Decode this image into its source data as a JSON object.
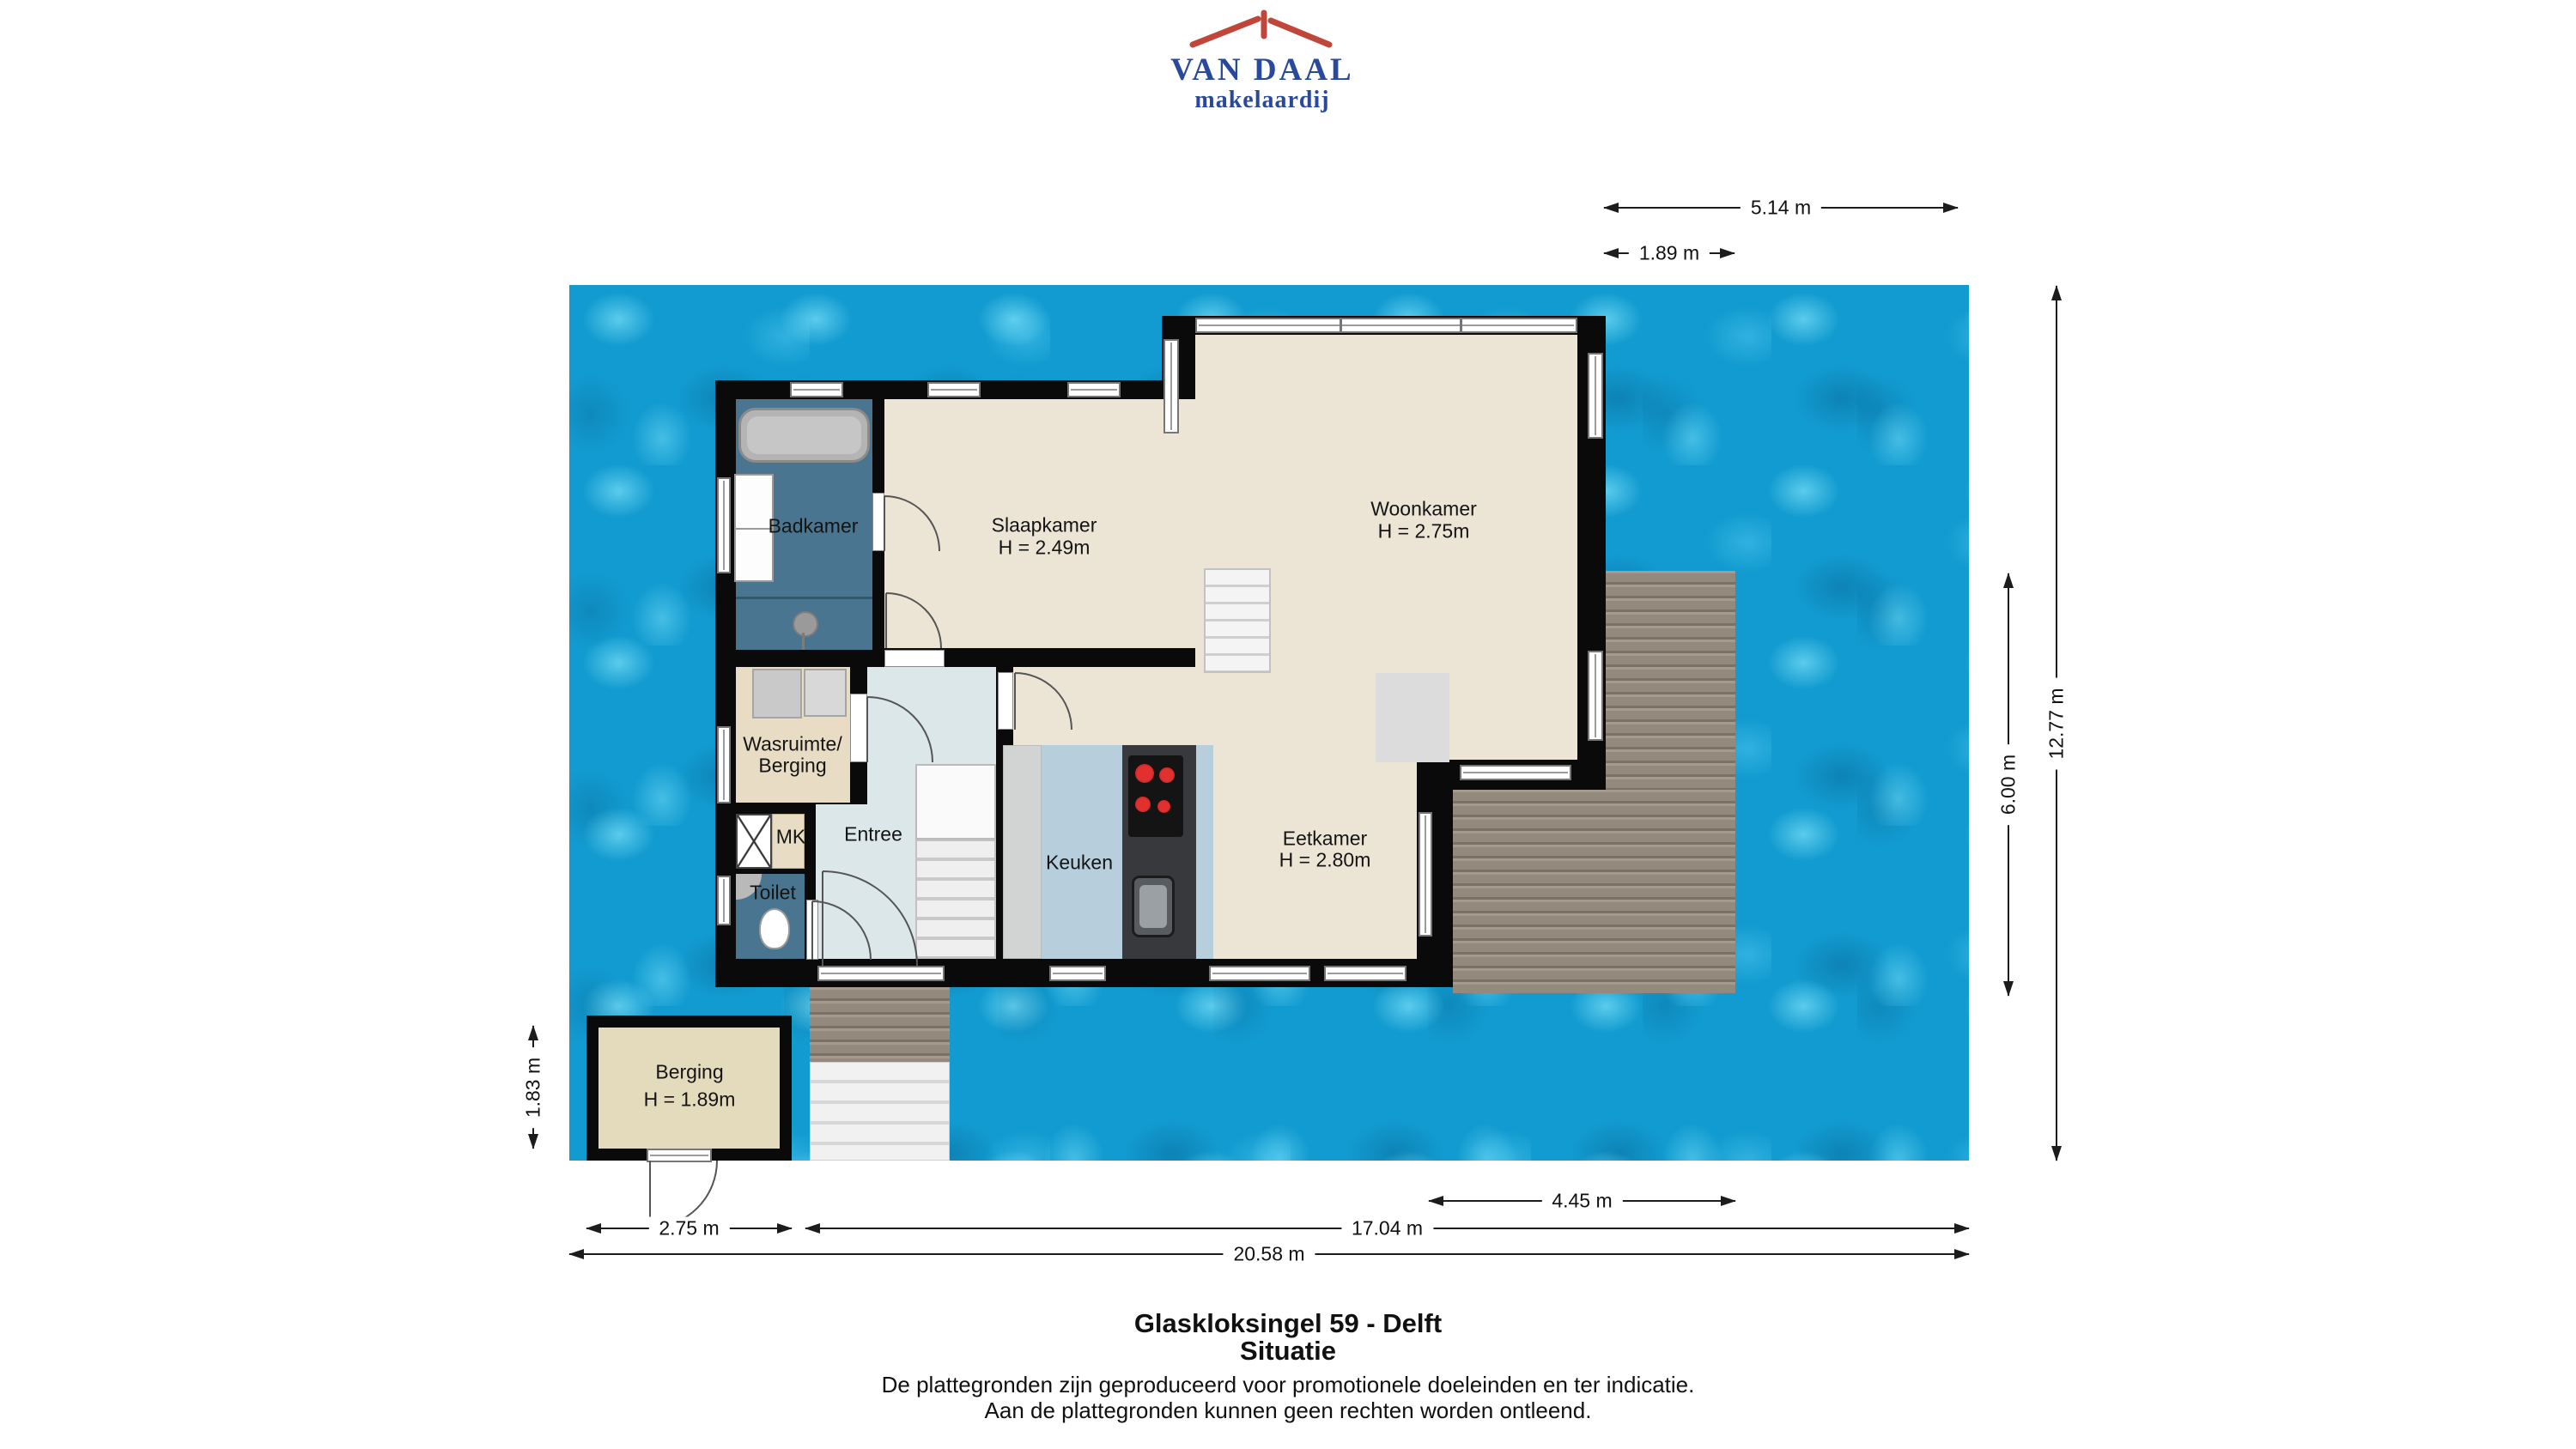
{
  "logo": {
    "title": "VAN DAAL",
    "subtitle": "makelaardij"
  },
  "rooms": {
    "badkamer": {
      "label": "Badkamer"
    },
    "slaapkamer": {
      "label": "Slaapkamer",
      "height": "H = 2.49m"
    },
    "woonkamer": {
      "label": "Woonkamer",
      "height": "H = 2.75m"
    },
    "wasruimte": {
      "line1": "Wasruimte/",
      "line2": "Berging"
    },
    "mk": {
      "label": "MK"
    },
    "toilet": {
      "label": "Toilet"
    },
    "entree": {
      "label": "Entree"
    },
    "keuken": {
      "label": "Keuken"
    },
    "eetkamer": {
      "label": "Eetkamer",
      "height": "H = 2.80m"
    },
    "berging": {
      "label": "Berging",
      "height": "H = 1.89m"
    }
  },
  "dimensions": {
    "top_width": "5.14 m",
    "top_width_small": "1.89 m",
    "right_total": "12.77 m",
    "right_deck": "6.00 m",
    "left_berging": "1.83 m",
    "bottom_deck": "4.45 m",
    "bottom_berging": "2.75 m",
    "bottom_house": "17.04 m",
    "bottom_total": "20.58 m"
  },
  "footer": {
    "title": "Glaskloksingel 59 - Delft",
    "subtitle": "Situatie",
    "disclaimer1": "De plattegronden zijn geproduceerd voor promotionele doeleinden en ter indicatie.",
    "disclaimer2": "Aan de plattegronden kunnen geen rechten worden ontleend."
  },
  "colors": {
    "water": "#129bd0",
    "wall": "#0a0a0a",
    "floor_beige": "#ece5d6",
    "wet_room_blue": "#4a7590",
    "utility_tan": "#e8ddc4",
    "entree_grey": "#dce7e9",
    "kitchen_blue": "#b7cedd",
    "deck_wood": "#94897d",
    "logo_blue": "#29499c",
    "logo_red": "#c0463a"
  }
}
